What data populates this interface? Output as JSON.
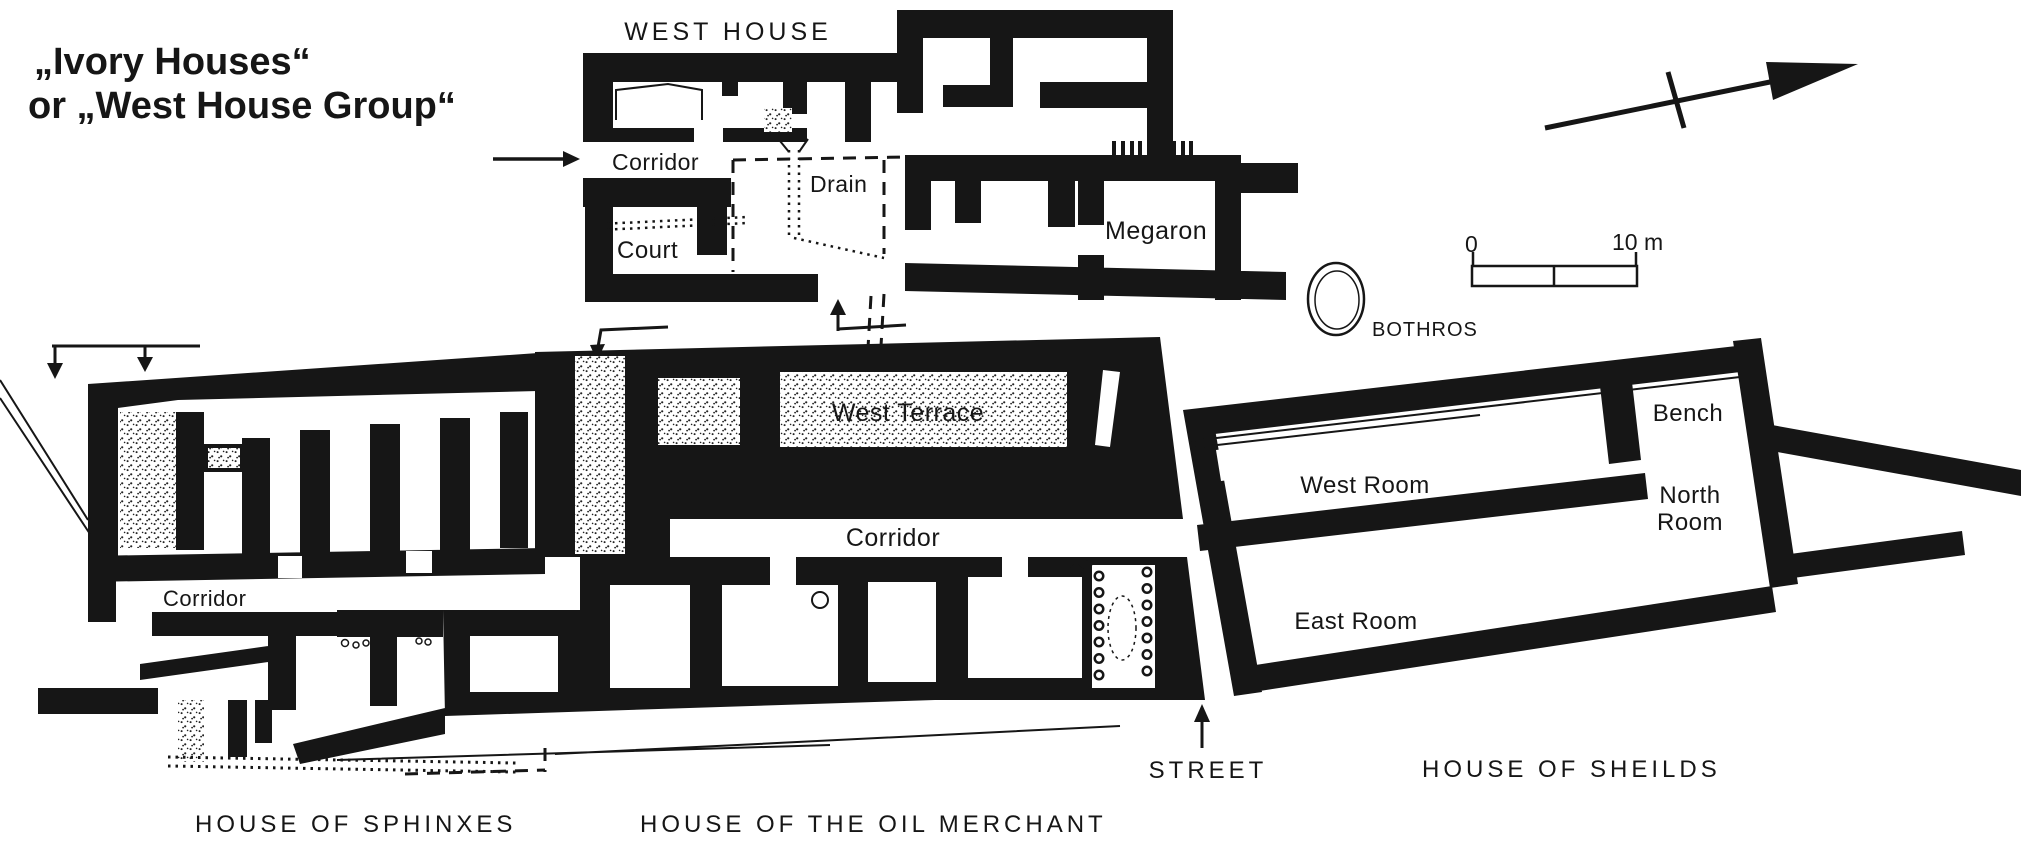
{
  "title": {
    "line1": "„Ivory Houses“",
    "line2": "or „West House Group“"
  },
  "west_house": {
    "label": "WEST HOUSE",
    "corridor": "Corridor",
    "drain": "Drain",
    "court": "Court",
    "megaron": "Megaron"
  },
  "bothros": {
    "label": "BOTHROS"
  },
  "scale_bar": {
    "zero": "0",
    "ten": "10 m"
  },
  "oil_merchant": {
    "label": "HOUSE OF THE OIL MERCHANT",
    "west_terrace": "West Terrace",
    "corridor": "Corridor"
  },
  "sphinxes": {
    "label": "HOUSE OF SPHINXES",
    "corridor": "Corridor"
  },
  "shields": {
    "label": "HOUSE OF SHEILDS",
    "bench": "Bench",
    "west_room": "West Room",
    "north_room_line1": "North",
    "north_room_line2": "Room",
    "east_room": "East Room"
  },
  "street": {
    "label": "STREET"
  },
  "icons": {
    "north_arrow": "north-arrow",
    "bothros_pit": "bothros-pit-circle",
    "direction_arrows": "flow-direction-arrows",
    "stairs": "staircase-hatch"
  },
  "colors": {
    "ink": "#161616",
    "paper": "#ffffff"
  }
}
